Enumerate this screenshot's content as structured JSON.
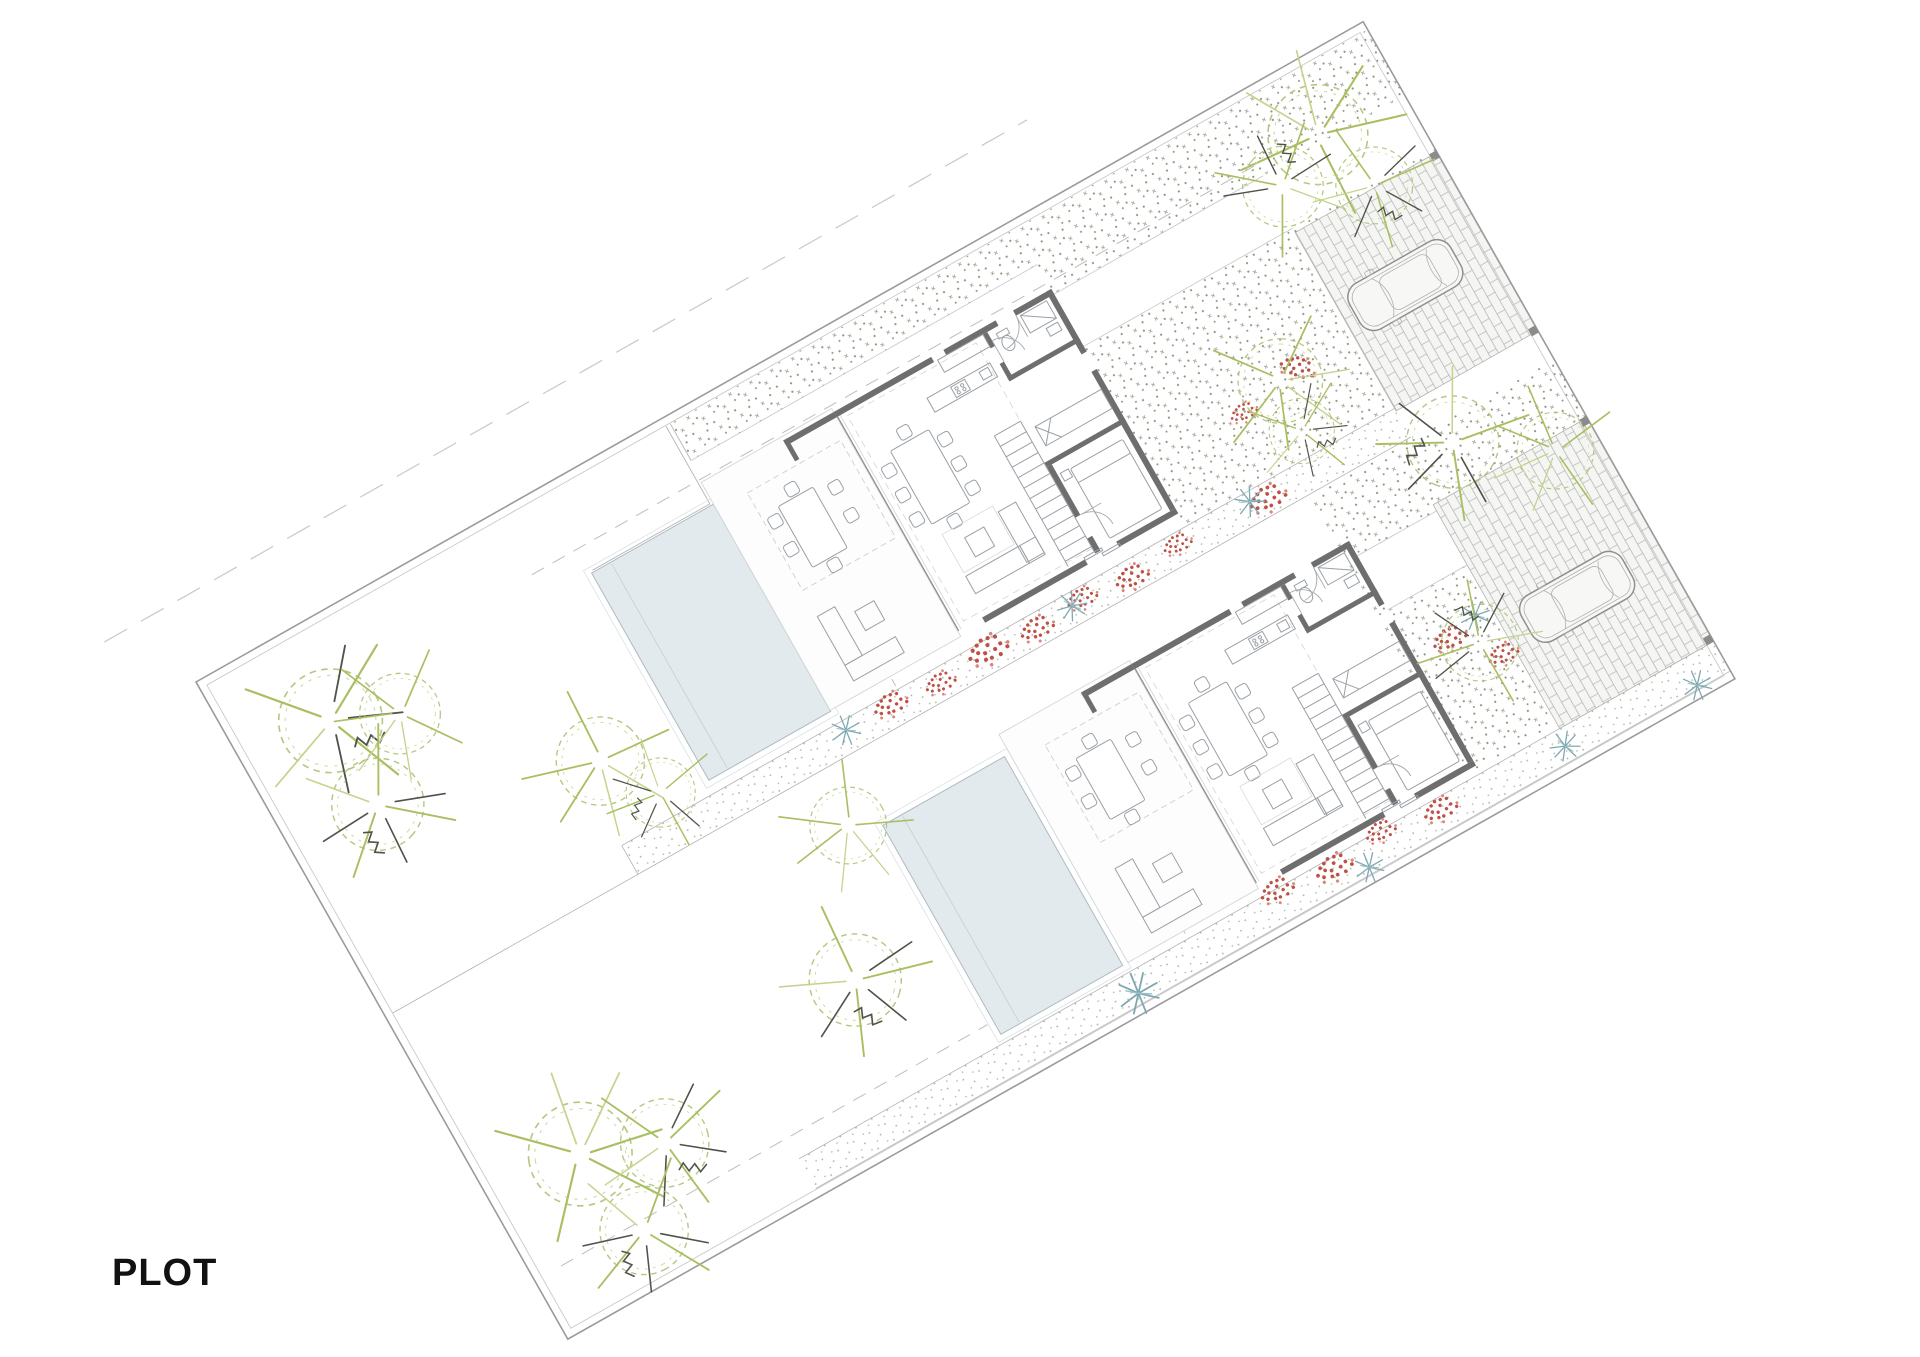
{
  "title": {
    "label": "PLOT"
  },
  "page": {
    "background": "#ffffff",
    "width_px": 1920,
    "height_px": 1357
  },
  "palette": {
    "label": "#111111",
    "boundary": "#9b9b9b",
    "wall": "#6e6e6e",
    "furniture": "#9aa0a6",
    "gravel_dot": "#8f957f",
    "brick_line": "#b2b6ae",
    "pool_fill": "#e3eaee",
    "pool_edge": "#aebbc1",
    "tree_outline": "#b5c77f",
    "tree_green": "#a9bf62",
    "tree_dark": "#4f534a",
    "flower_red": "#c04f45",
    "plant_teal": "#7fa9b2",
    "car_outline": "#8f8f8f",
    "dash": "#bdbdbd"
  },
  "plan": {
    "type": "architectural-site-plan",
    "rotation_deg": -29.5,
    "plot_count": 2,
    "units": [
      {
        "id": "villa-a",
        "features": [
          "house-floor-plan",
          "swimming-pool",
          "terrace",
          "outdoor-dining",
          "outdoor-lounge",
          "gravel-garden",
          "brick-driveway",
          "parked-car",
          "trees"
        ]
      },
      {
        "id": "villa-b",
        "features": [
          "house-floor-plan",
          "swimming-pool",
          "terrace",
          "outdoor-dining",
          "outdoor-lounge",
          "gravel-garden",
          "brick-driveway",
          "parked-car",
          "trees"
        ]
      }
    ],
    "counts": {
      "houses": 2,
      "pools": 2,
      "cars": 2,
      "trees": 18,
      "flower_patches": 16,
      "agave_plants": 8
    },
    "materials": [
      "gravel-stipple",
      "brick-paving",
      "lawn-white",
      "water"
    ]
  }
}
